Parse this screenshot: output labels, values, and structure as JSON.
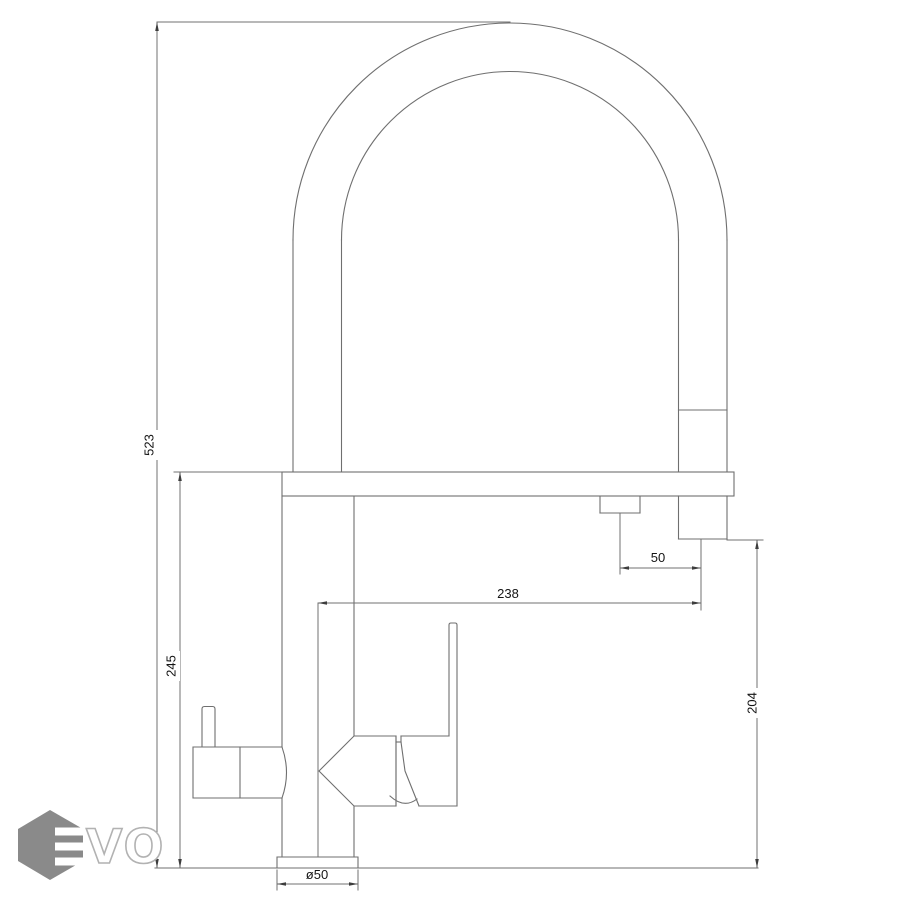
{
  "drawing": {
    "title": "faucet-front-elevation-technical-drawing",
    "dimensions": {
      "overall_height": {
        "value": "523",
        "orientation": "vertical"
      },
      "spout_height": {
        "value": "245",
        "orientation": "vertical"
      },
      "spout_reach": {
        "value": "238",
        "orientation": "horizontal"
      },
      "nozzle_offset": {
        "value": "50",
        "orientation": "horizontal"
      },
      "nozzle_clearance": {
        "value": "204",
        "orientation": "vertical"
      },
      "base_diameter": {
        "value": "ø50",
        "orientation": "horizontal"
      }
    },
    "logo": {
      "text": "VO",
      "mark": "hexagon-E"
    },
    "colors": {
      "background": "#ffffff",
      "line": "#6f6f6f",
      "label": "#141414",
      "logo_gray": "#8a8a8a",
      "logo_letter_outline": "#b2b2b2"
    }
  }
}
